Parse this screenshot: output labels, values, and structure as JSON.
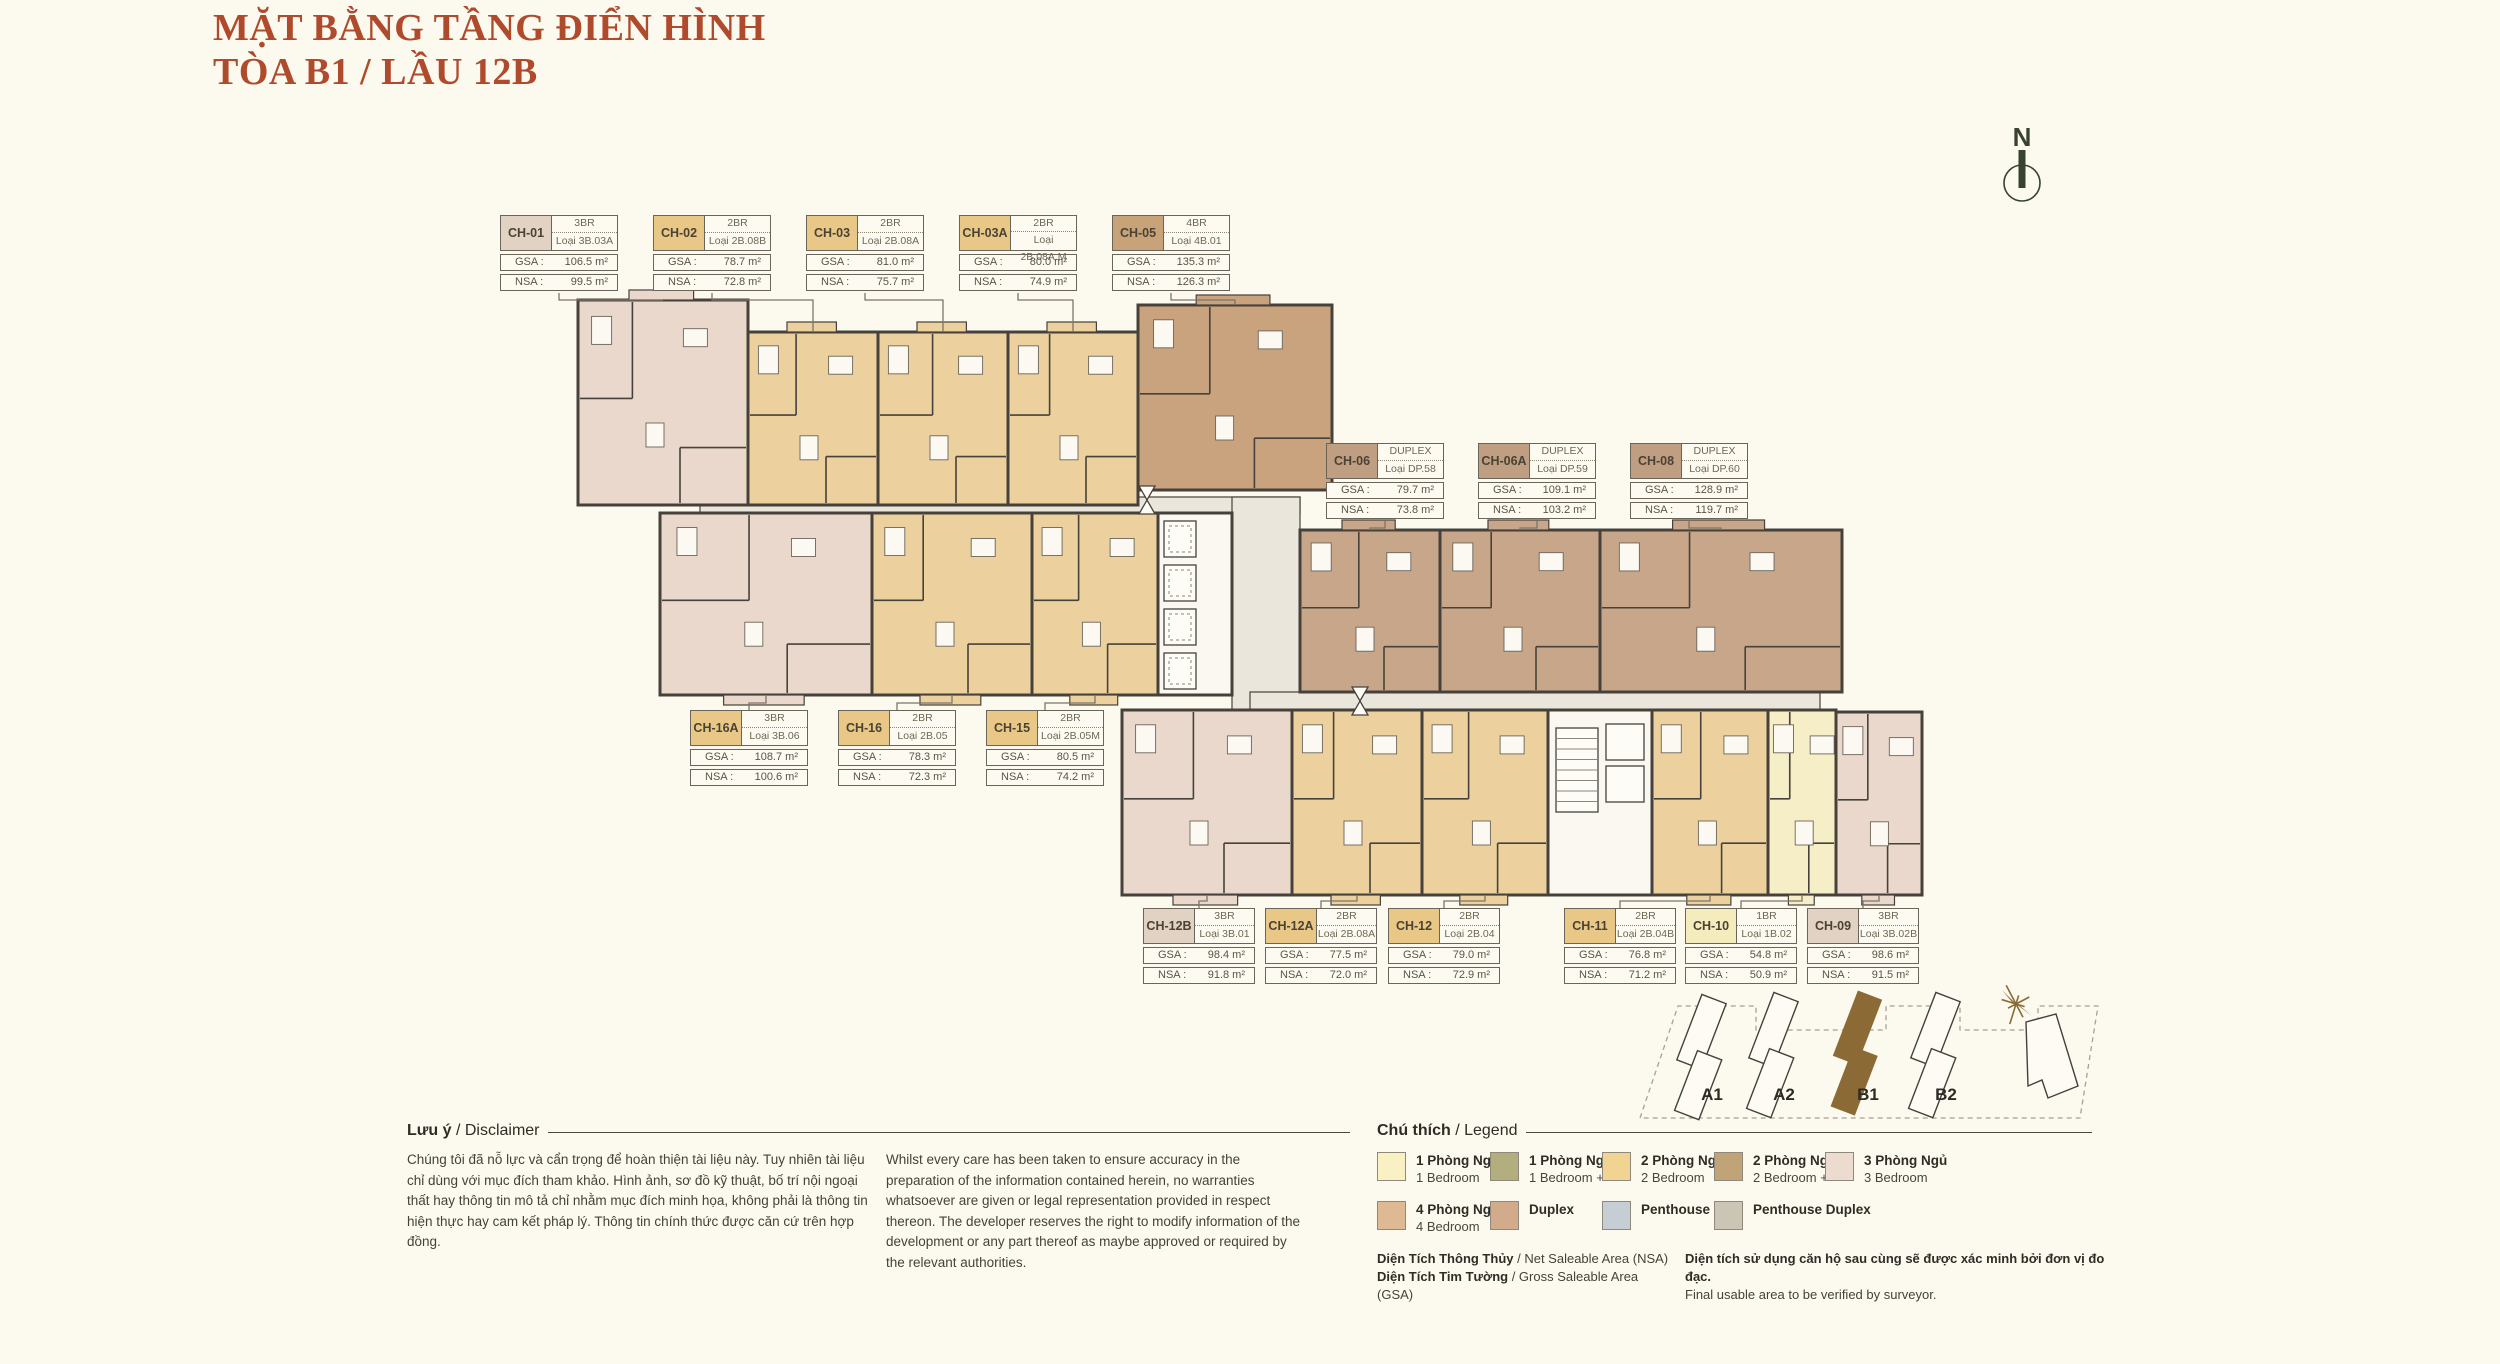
{
  "title": {
    "line1": "MẶT BẰNG TẦNG ĐIỂN HÌNH",
    "line2": "TÒA B1 / LẦU 12B"
  },
  "compass": {
    "label": "N"
  },
  "labels": {
    "gsa": "GSA :",
    "nsa": "NSA :"
  },
  "colors": {
    "bg": "#fcf9ef",
    "accent": "#b04a2c",
    "wall": "#46423b",
    "corridor": "#eae6dc",
    "core": "#faf8f1",
    "unit_1br": "#f6eec6",
    "unit_2br": "#ecd09d",
    "unit_3br": "#e9d8cb",
    "unit_4br": "#c9a37e",
    "unit_duplex": "#c7a68a",
    "card_border": "#6b6459",
    "card_1br": "#f4ecbc",
    "card_2br": "#e9c887",
    "card_3br": "#e2d2c3",
    "card_4br": "#c8a379",
    "card_duplex": "#bf9e81",
    "leader": "#7d7668",
    "site_highlight": "#8b6a35",
    "compass_ink": "#37422f"
  },
  "card_rows": [
    {
      "id": "top",
      "cards": [
        {
          "id": "CH-01",
          "type": "3BR",
          "loai": "Loại 3B.03A",
          "gsa": "106.5 m²",
          "nsa": "99.5 m²",
          "color_key": "card_3br"
        },
        {
          "id": "CH-02",
          "type": "2BR",
          "loai": "Loại 2B.08B",
          "gsa": "78.7 m²",
          "nsa": "72.8 m²",
          "color_key": "card_2br"
        },
        {
          "id": "CH-03",
          "type": "2BR",
          "loai": "Loại 2B.08A",
          "gsa": "81.0 m²",
          "nsa": "75.7 m²",
          "color_key": "card_2br"
        },
        {
          "id": "CH-03A",
          "type": "2BR",
          "loai": "Loại 2B.08A.M",
          "gsa": "80.0 m²",
          "nsa": "74.9 m²",
          "color_key": "card_2br"
        },
        {
          "id": "CH-05",
          "type": "4BR",
          "loai": "Loại 4B.01",
          "gsa": "135.3 m²",
          "nsa": "126.3 m²",
          "color_key": "card_4br"
        }
      ]
    },
    {
      "id": "duplex",
      "cards": [
        {
          "id": "CH-06",
          "type": "DUPLEX",
          "loai": "Loại DP.58",
          "gsa": "79.7 m²",
          "nsa": "73.8 m²",
          "color_key": "card_duplex"
        },
        {
          "id": "CH-06A",
          "type": "DUPLEX",
          "loai": "Loại DP.59",
          "gsa": "109.1 m²",
          "nsa": "103.2 m²",
          "color_key": "card_duplex"
        },
        {
          "id": "CH-08",
          "type": "DUPLEX",
          "loai": "Loại DP.60",
          "gsa": "128.9 m²",
          "nsa": "119.7 m²",
          "color_key": "card_duplex"
        }
      ]
    },
    {
      "id": "mid",
      "cards": [
        {
          "id": "CH-16A",
          "type": "3BR",
          "loai": "Loại 3B.06",
          "gsa": "108.7 m²",
          "nsa": "100.6 m²",
          "color_key": "card_2br"
        },
        {
          "id": "CH-16",
          "type": "2BR",
          "loai": "Loại 2B.05",
          "gsa": "78.3 m²",
          "nsa": "72.3 m²",
          "color_key": "card_2br"
        },
        {
          "id": "CH-15",
          "type": "2BR",
          "loai": "Loại 2B.05M",
          "gsa": "80.5 m²",
          "nsa": "74.2 m²",
          "color_key": "card_2br"
        }
      ]
    },
    {
      "id": "bottom",
      "cards": [
        {
          "id": "CH-12B",
          "type": "3BR",
          "loai": "Loại 3B.01",
          "gsa": "98.4 m²",
          "nsa": "91.8 m²",
          "color_key": "card_3br"
        },
        {
          "id": "CH-12A",
          "type": "2BR",
          "loai": "Loại 2B.08A",
          "gsa": "77.5 m²",
          "nsa": "72.0 m²",
          "color_key": "card_2br"
        },
        {
          "id": "CH-12",
          "type": "2BR",
          "loai": "Loại 2B.04",
          "gsa": "79.0 m²",
          "nsa": "72.9 m²",
          "color_key": "card_2br"
        },
        {
          "id": "CH-11",
          "type": "2BR",
          "loai": "Loại 2B.04B",
          "gsa": "76.8 m²",
          "nsa": "71.2 m²",
          "color_key": "card_2br"
        },
        {
          "id": "CH-10",
          "type": "1BR",
          "loai": "Loại 1B.02",
          "gsa": "54.8 m²",
          "nsa": "50.9 m²",
          "color_key": "card_1br"
        },
        {
          "id": "CH-09",
          "type": "3BR",
          "loai": "Loại 3B.02B",
          "gsa": "98.6 m²",
          "nsa": "91.5 m²",
          "color_key": "card_3br"
        }
      ]
    }
  ],
  "legend": {
    "title_vn": "Chú thích",
    "title_en": "/ Legend",
    "rows": [
      [
        {
          "vn": "1 Phòng Ngủ",
          "en": "1 Bedroom",
          "color": "#f9f1c4"
        },
        {
          "vn": "1 Phòng Ngủ +",
          "en": "1 Bedroom +",
          "color": "#b2ae7e"
        },
        {
          "vn": "2 Phòng Ngủ",
          "en": "2 Bedroom",
          "color": "#f1d491"
        },
        {
          "vn": "2 Phòng Ngủ +",
          "en": "2 Bedroom +",
          "color": "#c0a478"
        },
        {
          "vn": "3 Phòng Ngủ",
          "en": "3 Bedroom",
          "color": "#ecdccf"
        }
      ],
      [
        {
          "vn": "4 Phòng Ngủ",
          "en": "4 Bedroom",
          "color": "#ddba92"
        },
        {
          "vn": "Duplex",
          "en": "",
          "color": "#d2ab8a"
        },
        {
          "vn": "Penthouse",
          "en": "",
          "color": "#c4ced4"
        },
        {
          "vn": "Penthouse Duplex",
          "en": "",
          "color": "#cac5b5"
        }
      ]
    ]
  },
  "disclaimer": {
    "title_vn": "Lưu ý",
    "title_en": "/ Disclaimer",
    "vn": "Chúng tôi đã nỗ lực và cẩn trọng để hoàn thiện tài liệu này. Tuy nhiên tài liệu chỉ dùng với mục đích tham khảo. Hình ảnh, sơ đồ kỹ thuật, bố trí nội ngoại thất hay thông tin mô tả chỉ nhằm mục đích minh họa, không phải là thông tin hiện thực hay cam kết pháp lý. Thông tin chính thức được căn cứ trên hợp đồng.",
    "en": "Whilst every care has been taken to ensure accuracy in the preparation of the information contained herein, no warranties whatsoever are given or legal representation provided in respect thereon. The developer reserves the right to modify information of the development or any part thereof as maybe approved or required by the relevant authorities."
  },
  "area_notes": {
    "nsa_vn": "Diện Tích Thông Thủy",
    "nsa_en": " / Net Saleable Area (NSA)",
    "gsa_vn": "Diện Tích Tim Tường",
    "gsa_en": " / Gross Saleable Area (GSA)",
    "note_vn": "Diện tích sử dụng căn hộ sau cùng sẽ được xác minh bởi đơn vị đo đạc.",
    "note_en": "Final usable area to be verified by surveyor."
  },
  "site_map": {
    "buildings": [
      {
        "label": "A1",
        "highlighted": false
      },
      {
        "label": "A2",
        "highlighted": false
      },
      {
        "label": "B1",
        "highlighted": true
      },
      {
        "label": "B2",
        "highlighted": false
      }
    ]
  }
}
